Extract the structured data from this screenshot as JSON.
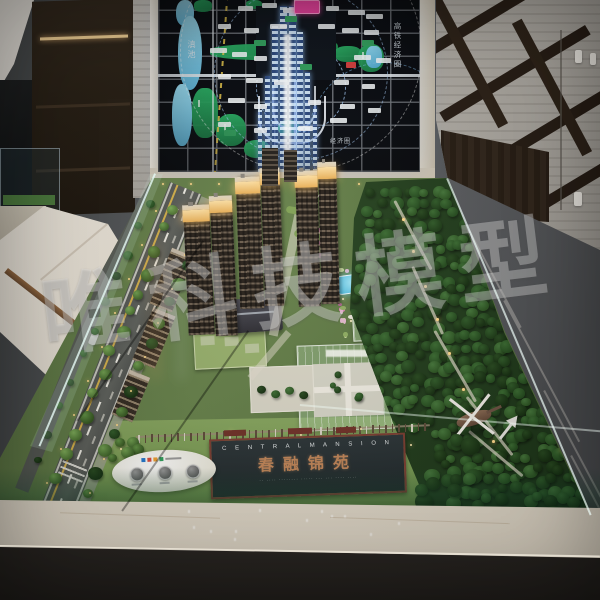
{
  "watermark": {
    "prefix_glyph": "唯",
    "text": "科技模型"
  },
  "display_map": {
    "lake_label": "滇池",
    "corridor_label": "高铁经济圈",
    "zone_label": "经济圈"
  },
  "sign_board": {
    "title_en": "C E N T R A L   M A N S I O N",
    "title_cn": "春融锦苑",
    "subtitle": "·· ···· ········ ····· ···   ··· ···· ····"
  },
  "palette": {
    "crown_glow": "#f2bc5e",
    "map_magenta": "#ee3fa0",
    "lake_blue": "#8fd8f2",
    "park_green": "#1f9e57",
    "led_blue": "#9fd0ff",
    "lawn_green": "#6f9c4f",
    "forest_green": "#2a5226",
    "marble_light": "#efe9dd",
    "sign_frame_red": "#7a3b30"
  }
}
